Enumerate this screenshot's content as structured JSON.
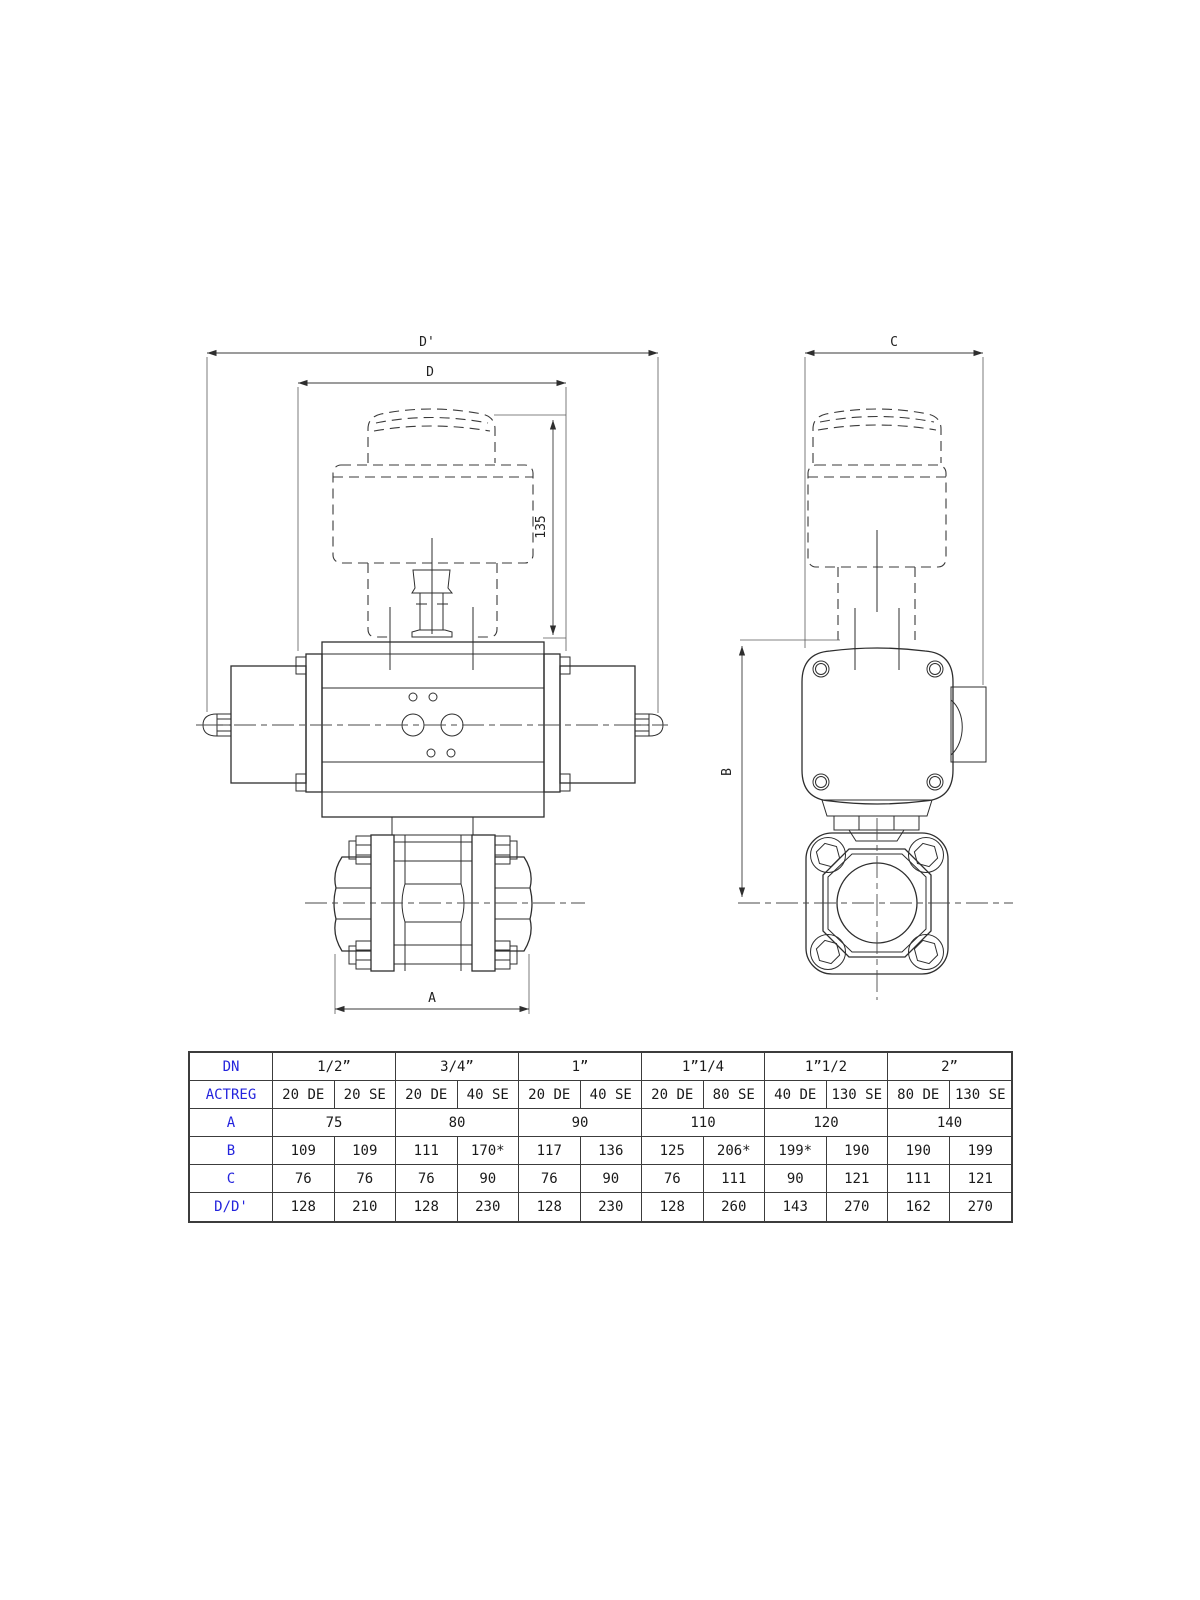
{
  "drawing": {
    "labels": {
      "dim_d_prime": "D'",
      "dim_d": "D",
      "dim_135": "135",
      "dim_c": "C",
      "dim_b": "B",
      "dim_a": "A"
    }
  },
  "table": {
    "row_headers": [
      "DN",
      "ACTREG",
      "A",
      "B",
      "C",
      "D/D'"
    ],
    "dn_sizes": [
      "1/2”",
      "3/4”",
      "1”",
      "1”1/4",
      "1”1/2",
      "2”"
    ],
    "actreg": [
      "20 DE",
      "20 SE",
      "20 DE",
      "40 SE",
      "20 DE",
      "40 SE",
      "20 DE",
      "80 SE",
      "40 DE",
      "130 SE",
      "80 DE",
      "130 SE"
    ],
    "a_values": [
      "75",
      "80",
      "90",
      "110",
      "120",
      "140"
    ],
    "b_values": [
      "109",
      "109",
      "111",
      "170*",
      "117",
      "136",
      "125",
      "206*",
      "199*",
      "190",
      "190",
      "199"
    ],
    "c_values": [
      "76",
      "76",
      "76",
      "90",
      "76",
      "90",
      "76",
      "111",
      "90",
      "121",
      "111",
      "121"
    ],
    "dd_values": [
      "128",
      "210",
      "128",
      "230",
      "128",
      "230",
      "128",
      "260",
      "143",
      "270",
      "162",
      "270"
    ]
  },
  "colors": {
    "header_blue": "#2424dd",
    "line": "#2e2e2e"
  }
}
